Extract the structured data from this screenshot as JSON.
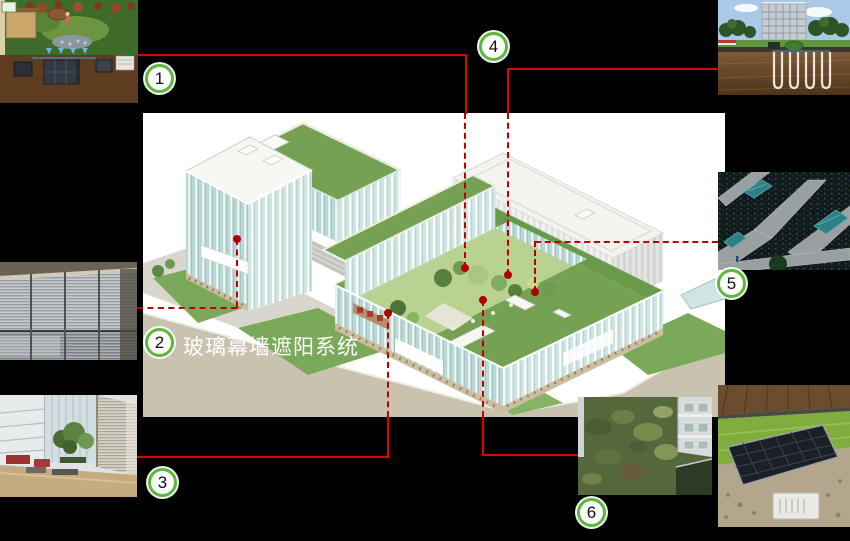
{
  "slide": {
    "background": "#000000",
    "caption": {
      "text": "玻璃幕墙遮阳系统"
    },
    "callouts": [
      {
        "label": "1",
        "topic": "rainwater-garden-recycling-system"
      },
      {
        "label": "2",
        "topic": "glass-curtain-wall-shading-system"
      },
      {
        "label": "3",
        "topic": "daylit-atrium"
      },
      {
        "label": "4",
        "topic": "ground-source-heat-pump-system"
      },
      {
        "label": "5",
        "topic": "wetland-pond-landscape"
      },
      {
        "label": "6",
        "topic": "green-roof"
      }
    ],
    "colors": {
      "callout_ring": "#5db83c",
      "connector_solid": "#e00000",
      "connector_dashed": "#c00000",
      "anchor_dot": "#b00000",
      "caption_text": "#ffffff"
    }
  }
}
